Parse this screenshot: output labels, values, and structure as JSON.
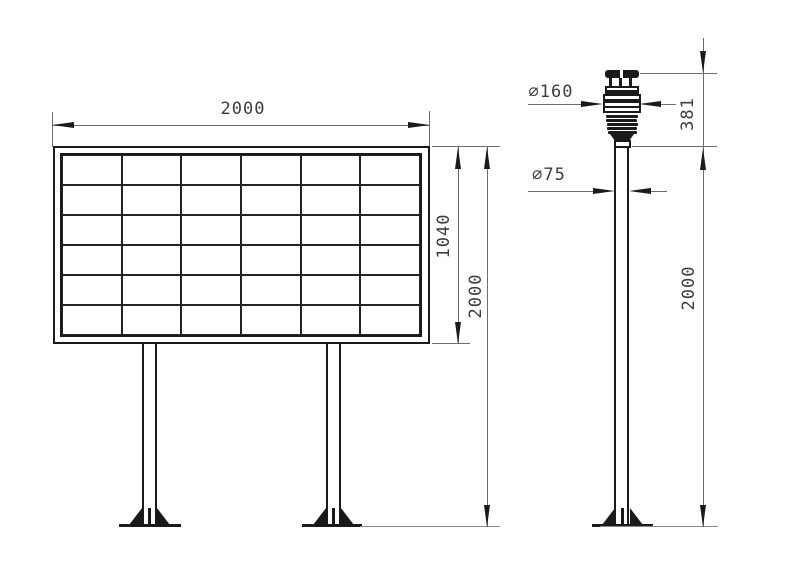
{
  "colors": {
    "geometry": "#1a1a1a",
    "dimension": "#6e6e6e",
    "ground": "#8a8a8a",
    "text": "#3d3d3d"
  },
  "board_view": {
    "grid": {
      "rows": 6,
      "cols": 6
    },
    "dim_width": "2000",
    "dim_panel_height": "1040",
    "dim_total_height": "2000"
  },
  "sensor_view": {
    "dim_sensor_diameter": "∅160",
    "dim_pole_diameter": "∅75",
    "dim_sensor_height": "381",
    "dim_pole_height": "2000"
  }
}
